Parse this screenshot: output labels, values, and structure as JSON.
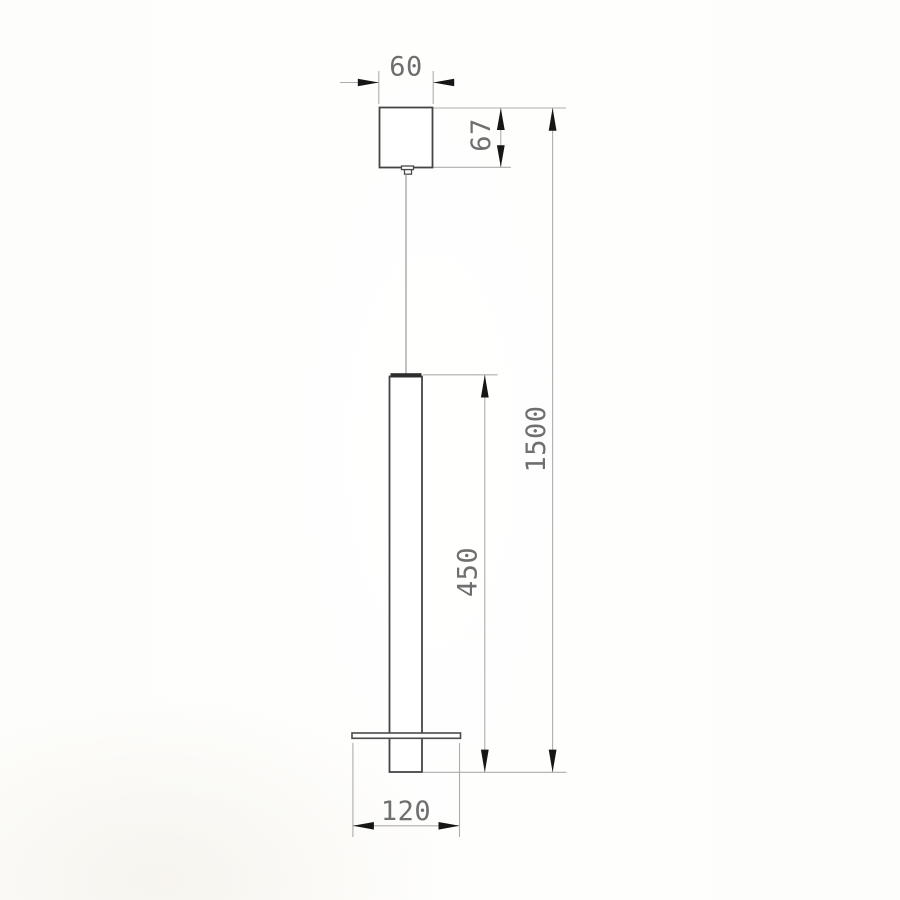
{
  "drawing": {
    "description": "pendant lamp technical dimension drawing",
    "dimensions": {
      "canopy_width": "60",
      "canopy_height": "67",
      "tube_length": "450",
      "overall_drop": "1500",
      "base_plate_width": "120"
    },
    "colors": {
      "object_line": "#454545",
      "dimension_line": "#adadad",
      "arrowhead": "#161616",
      "dimension_text": "#6f6f6f",
      "background": "#fdfdfb"
    }
  }
}
